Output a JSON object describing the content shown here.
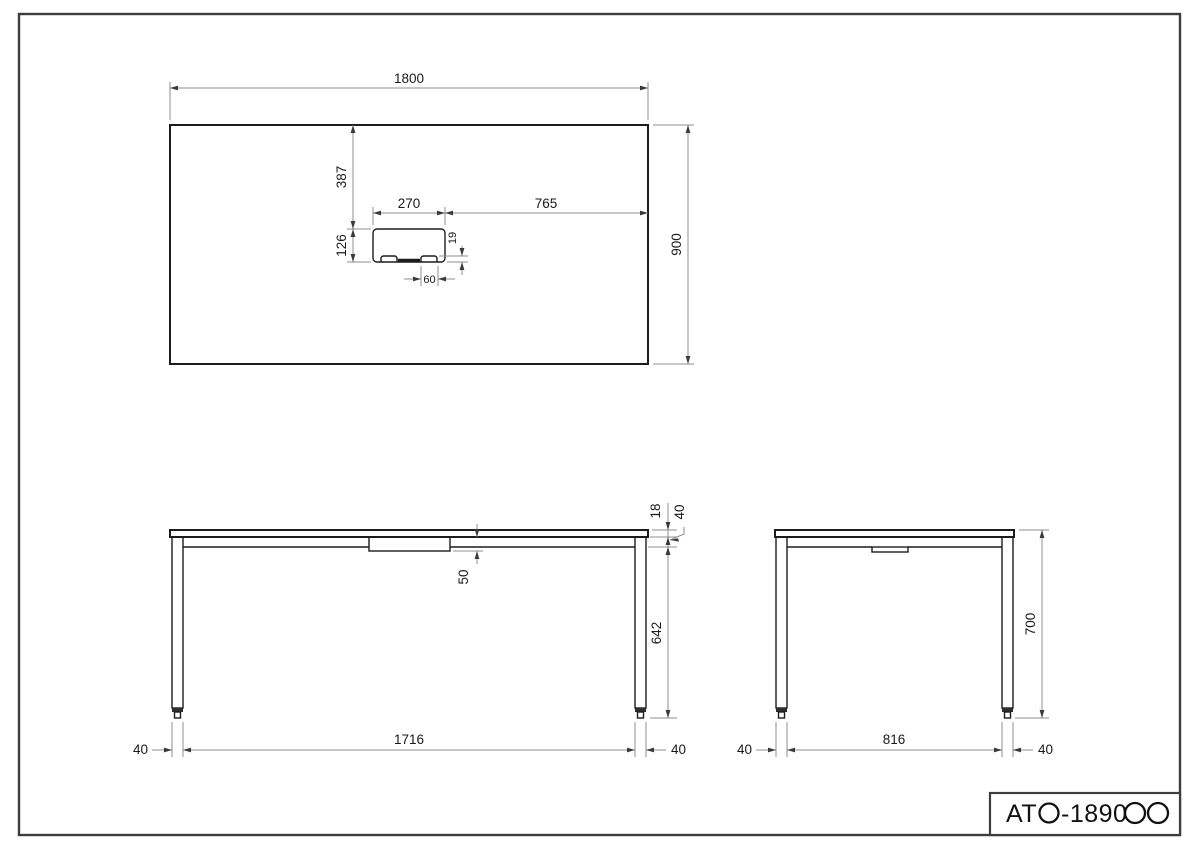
{
  "sheet": {
    "product_code_prefix": "AT",
    "product_code_mid": "-1890",
    "product_code_full": "ATO-1890OO"
  },
  "plan_view": {
    "overall_width": "1800",
    "overall_depth": "900",
    "grommet_width": "270",
    "grommet_offset_right": "765",
    "grommet_offset_top": "387",
    "grommet_depth": "126",
    "flap_height": "19",
    "flap_width": "60"
  },
  "front_view": {
    "top_thickness": "18",
    "frame_height": "40",
    "tray_drop": "50",
    "leg_height": "642",
    "leg_width_left": "40",
    "leg_span_inner": "1716",
    "leg_width_right": "40"
  },
  "side_view": {
    "overall_height": "700",
    "leg_width_left": "40",
    "leg_span_inner": "816",
    "leg_width_right": "40"
  },
  "colors": {
    "object_line": "#1c1c1c",
    "dimension_line": "#8f8f8f",
    "text": "#1a1a1a"
  }
}
